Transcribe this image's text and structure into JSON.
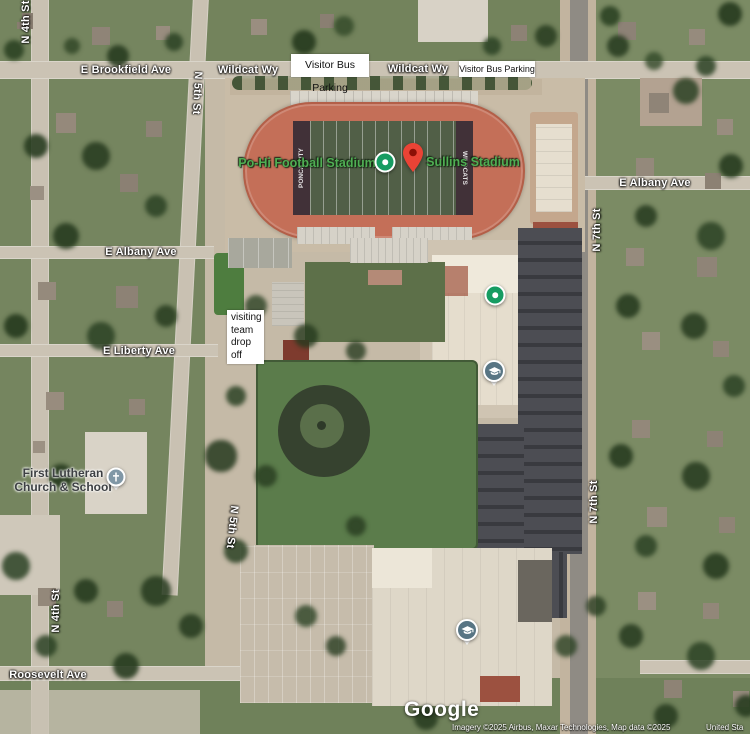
{
  "map": {
    "street_labels": {
      "n4th_top": "N 4th St",
      "brookfield": "E Brookfield Ave",
      "n5th_top": "N 5th St",
      "wildcat_1": "Wildcat Wy",
      "wildcat_2": "Wildcat Wy",
      "albany_right": "E Albany Ave",
      "n7th_top": "N 7th St",
      "albany_left": "E Albany Ave",
      "liberty": "E Liberty Ave",
      "n5th_bottom": "N 5th St",
      "n7th_bottom": "N 7th St",
      "n4th_bottom": "N 4th St",
      "roosevelt": "Roosevelt Ave"
    },
    "poi_labels": {
      "football_stadium": "Po-Hi Football Stadium",
      "sullins_stadium": "Sullins Stadium",
      "church_line1": "First Lutheran",
      "church_line2": "Church & School"
    },
    "overlays": {
      "visitor_bus_1": "Visitor Bus Parking",
      "visitor_bus_2": "Visitor Bus Parking",
      "visiting_team": "visiting team drop off"
    },
    "field_text": {
      "left_endzone": "PONCA CITY",
      "right_endzone": "WILDCATS"
    },
    "markers": {
      "green_dot_color": "#169c62",
      "pin_red": "#ea4335",
      "school_slate": "#587584",
      "church_slate": "#8097a6"
    },
    "branding": {
      "logo": "Google"
    },
    "attribution": {
      "main": "Imagery ©2025 Airbus, Maxar Technologies, Map data ©2025",
      "right": "United Sta"
    },
    "colors": {
      "poi_label_green": "#4fae53",
      "track_red": "#c46f58",
      "field_green": "#515f47"
    }
  }
}
